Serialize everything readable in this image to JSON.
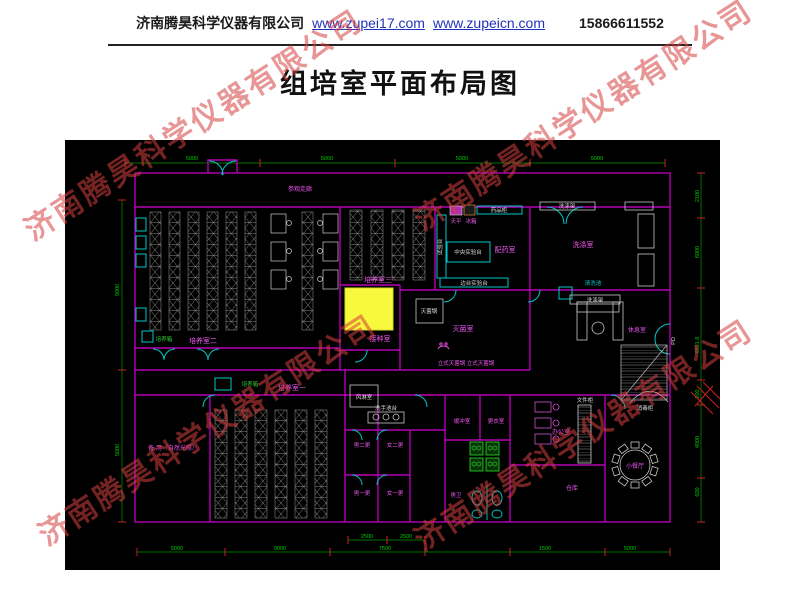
{
  "header": {
    "company": "济南腾昊科学仪器有限公司",
    "link1": "www.zupei17.com",
    "link2": "www.zupeicn.com",
    "phone": "15866611552"
  },
  "title": "组培室平面布局图",
  "watermark": "济南腾昊科学仪器有限公司",
  "plan": {
    "rooms": {
      "corridor": "参观走廊",
      "culture3": "培养室三",
      "culture2": "培养室二",
      "culture1": "培养室一",
      "inoculation": "接种室",
      "sterilization": "灭菌室",
      "prep": "配药室",
      "washing": "洗涤室",
      "lounge": "休息室",
      "spare": "备 用（自然光照）",
      "air_shower": "风淋室",
      "chg_m2": "男二更",
      "chg_f2": "女二更",
      "chg_m1": "男一更",
      "chg_f1": "女一更",
      "buffer": "缓冲室",
      "dressing": "更衣室",
      "wc_m": "男卫",
      "office": "办公室",
      "storage": "仓库",
      "dining": "小餐厅"
    },
    "equipment": {
      "incubator": "培养箱",
      "incubator2": "培养箱",
      "balance": "天平",
      "fridge": "冰箱",
      "med_cabinet": "药品柜",
      "central_bench": "中央实验台",
      "side_bench": "边台实验台",
      "side_bench_v": "试验台",
      "sterilizer_pot": "灭菌锅",
      "vertical_sterilizers": "立式灭菌锅 立式灭菌锅",
      "wash_rack_top": "洗涤架",
      "wash_rack_bottom": "洗涤架",
      "sink": "清洗池",
      "hand_sink": "洗手池台",
      "file_cabinet": "文件柜",
      "disinfect_cabinet": "消毒柜",
      "door_pd": "PD"
    },
    "dims": {
      "top": [
        "5000",
        "5000",
        "5000",
        "5000"
      ],
      "left": [
        "9000",
        "5000"
      ],
      "right": [
        "2100",
        "6000",
        "9021.6",
        "200",
        "4000",
        "600"
      ],
      "bottom": [
        "5000",
        "9000",
        "2500",
        "2500",
        "7500",
        "1500",
        "5000"
      ]
    }
  }
}
